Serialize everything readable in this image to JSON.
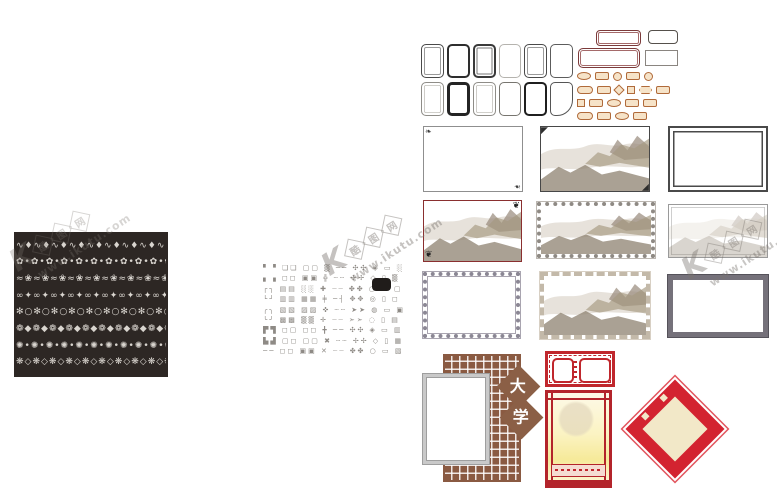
{
  "page": {
    "background": "#ffffff"
  },
  "colors": {
    "panel_black": "#2d2724",
    "lattice_brown": "#8a5a42",
    "lattice_red": "#c0272d",
    "diamond_red": "#d32330",
    "diamond_cream": "#f2e8c8",
    "label_orange": "#b06a3a",
    "maroon_frame": "#8a2f2f",
    "watermark_gray": "#7a7570"
  },
  "ornament_panel": {
    "rows": [
      "∿♦∿♦∿♦∿♦∿♦∿♦∿♦∿♦∿♦∿♦∿♦∿♦∿♦∿♦∿♦∿♦∿♦∿♦",
      "✿•✿•✿•✿•✿•✿•✿•✿•✿•✿•✿•✿•✿•✿•✿•✿•✿•✿•",
      "≈❀≈❀≈❀≈❀≈❀≈❀≈❀≈❀≈❀≈❀≈❀≈❀≈❀≈❀≈❀≈❀≈❀≈❀",
      "∞✦∞✦∞✦∞✦∞✦∞✦∞✦∞✦∞✦∞✦∞✦∞✦∞✦∞✦∞✦∞✦∞✦∞✦",
      "✻○✻○✻○✻○✻○✻○✻○✻○✻○✻○✻○✻○✻○✻○✻○✻○✻○✻○",
      "❁◆❁◆❁◆❁◆❁◆❁◆❁◆❁◆❁◆❁◆❁◆❁◆❁◆❁◆❁◆❁◆❁◆❁◆",
      "✺•✺•✺•✺•✺•✺•✺•✺•✺•✺•✺•✺•✺•✺•✺•✺•✺•✺•",
      "❋◇❋◇❋◇❋◇❋◇❋◇❋◇❋◇❋◇❋◇❋◇❋◇❋◇❋◇❋◇❋◇❋◇❋◇"
    ]
  },
  "ornament_sampler": {
    "rows": [
      "▘▝ ❏❏ ▢▢ ▒ ── ✣✣ ◈ ▭ ░",
      "▖▗ ◻◻ ▣▣ ╬ ┄┄ ✢✢ ◇ ▯ ▒",
      "┌┐ ▤▤ ░░ ✚ ┈┈ ✤✤ ○ ▭ ▢",
      "└┘ ▥▥ ▦▦ ╪ ─┤ ✥✥ ◎ ▯ ◻",
      "╭╮ ▧▧ ▨▨ ✜ ┄┄ ➤➤ ◍ ▭ ▣",
      "╰╯ ▩▩ ▒▒ ✛ ┈┈ ➣➣ ◌ ▯ ▤",
      "▛▜ ◻▢ ◻◻ ╋ ── ✣✣ ◈ ▭ ▥",
      "▙▟ ▢◻ ▢▢ ✖ ┄┄ ✢✢ ◇ ▯ ▦",
      "── ◻◻ ▣▣ ✕ ┈┈ ✤✤ ○ ▭ ▧"
    ],
    "swatch_color": "#201c1a"
  },
  "mini_frames": {
    "variants": [
      "double",
      "dark",
      "thick",
      "light",
      "double",
      "thin",
      "soft",
      "darkfill",
      "soft",
      "plain",
      "heavy",
      "cornered"
    ]
  },
  "label_shapes": {
    "items": [
      "oval",
      "rect",
      "circle",
      "rect",
      "circle",
      "pill",
      "rect",
      "diamond",
      "sq",
      "hex",
      "rect",
      "sq",
      "rect",
      "oval",
      "rect",
      "rect",
      "pill",
      "rect",
      "oval",
      "rect"
    ]
  },
  "university": {
    "chars": [
      "大",
      "学"
    ]
  },
  "watermark": {
    "logo": "K",
    "site_chars": [
      "酷",
      "图",
      "网"
    ],
    "url": "www.ikutu.com"
  }
}
